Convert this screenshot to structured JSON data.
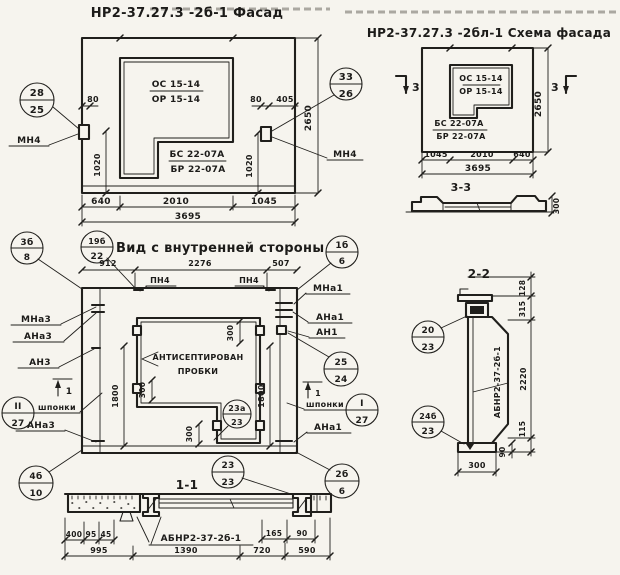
{
  "facade": {
    "title": "НР2-37.27.3 -2б-1 Фасад",
    "window_mark_top": "ОС 15-14",
    "window_mark_bottom": "ОР 15-14",
    "sill_mark_top": "БС 22-07А",
    "sill_mark_bottom": "БР 22-07А",
    "anchor_left": "МН4",
    "anchor_right": "МН4",
    "callout_left_num": "28",
    "callout_left_sheet": "25",
    "callout_right_num": "33",
    "callout_right_sheet": "26",
    "dim_80_left": "80",
    "dim_80_right": "80",
    "dim_405": "405",
    "dim_1020_left": "1020",
    "dim_1020_right": "1020",
    "dim_2650": "2650",
    "dim_640": "640",
    "dim_2010": "2010",
    "dim_1045": "1045",
    "dim_3695": "3695"
  },
  "scheme": {
    "title": "НР2-37.27.3 -2бл-1 Схема фасада",
    "window_mark_top": "ОС 15-14",
    "window_mark_bottom": "ОР 15-14",
    "sill_mark_top": "БС 22-07А",
    "sill_mark_bottom": "БР 22-07А",
    "section_mark_left": "3",
    "section_mark_right": "3",
    "dim_2650": "2650",
    "dim_1045": "1045",
    "dim_2010": "2010",
    "dim_640": "640",
    "dim_3695": "3695"
  },
  "section33": {
    "title": "3-3",
    "dim_300": "300"
  },
  "inner": {
    "title": "Вид с внутренней стороны",
    "dim_912": "912",
    "dim_2276": "2276",
    "dim_507": "507",
    "anchor_top_left": "ПН4",
    "anchor_top_right": "ПН4",
    "callout_3b_num": "3б",
    "callout_3b_sheet": "8",
    "callout_19b_num": "19б",
    "callout_19b_sheet": "22",
    "callout_1b_num": "1б",
    "callout_1b_sheet": "6",
    "label_mna3": "МНа3",
    "label_ana3_top": "АНа3",
    "label_an3": "АН3",
    "label_shponki_left": "шпонки",
    "label_ana3_bottom": "АНа3",
    "callout_II_num": "II",
    "callout_II_sheet": "27",
    "callout_4b_num": "4б",
    "callout_4b_sheet": "10",
    "label_mna1": "МНа1",
    "label_ana1_top": "АНа1",
    "label_an1": "АН1",
    "label_shponki_right": "шпонки",
    "label_ana1_bottom": "АНа1",
    "callout_25_num": "25",
    "callout_25_sheet": "24",
    "callout_I_num": "I",
    "callout_I_sheet": "27",
    "callout_2b_num": "2б",
    "callout_2b_sheet": "6",
    "callout_23a_num": "23а",
    "callout_23a_sheet": "23",
    "note_line1": "АНТИСЕПТИРОВАН",
    "note_line2": "ПРОБКИ",
    "dim_1800_left": "1800",
    "dim_1800_right": "1800",
    "dim_300_top": "300",
    "dim_300_left": "300",
    "dim_300_bottom": "300",
    "section_mark_left": "1",
    "section_mark_right": "1"
  },
  "section11": {
    "title": "1-1",
    "callout_23_num": "23",
    "callout_23_sheet": "23",
    "product_mark": "АБНР2-37-2б-1",
    "dim_400": "400",
    "dim_95": "95",
    "dim_45": "45",
    "dim_165": "165",
    "dim_90": "90",
    "dim_995": "995",
    "dim_1390": "1390",
    "dim_720": "720",
    "dim_590": "590"
  },
  "section22": {
    "title": "2-2",
    "callout_20_num": "20",
    "callout_20_sheet": "23",
    "callout_24b_num": "24б",
    "callout_24b_sheet": "23",
    "product_mark": "АБНР2-37-2б-1",
    "dim_128": "128",
    "dim_315": "315",
    "dim_2220": "2220",
    "dim_115": "115",
    "dim_90": "90",
    "dim_300": "300"
  }
}
